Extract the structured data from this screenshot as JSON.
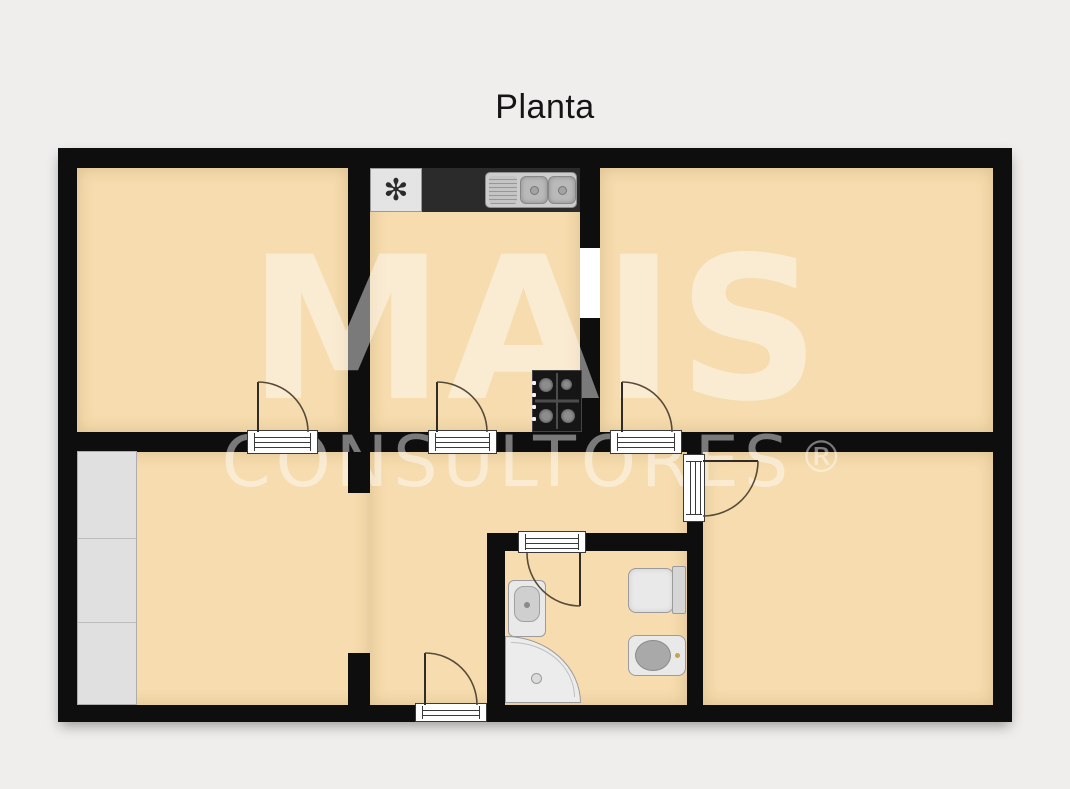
{
  "title": "Planta",
  "watermark": {
    "line1": "MAIS",
    "line2": "CONSULTORES",
    "registered": "®"
  },
  "colors": {
    "background": "#f0eeec",
    "floor": "#f6dcae",
    "wall": "#0e0e0e",
    "counter": "#2b2b2b",
    "watermark": "rgba(255,255,255,0.45)"
  },
  "fixtures": [
    "extractor-fan",
    "double-kitchen-sink",
    "gas-stove-4-burner",
    "wardrobe",
    "washbasin",
    "corner-shower",
    "toilet",
    "bidet"
  ]
}
